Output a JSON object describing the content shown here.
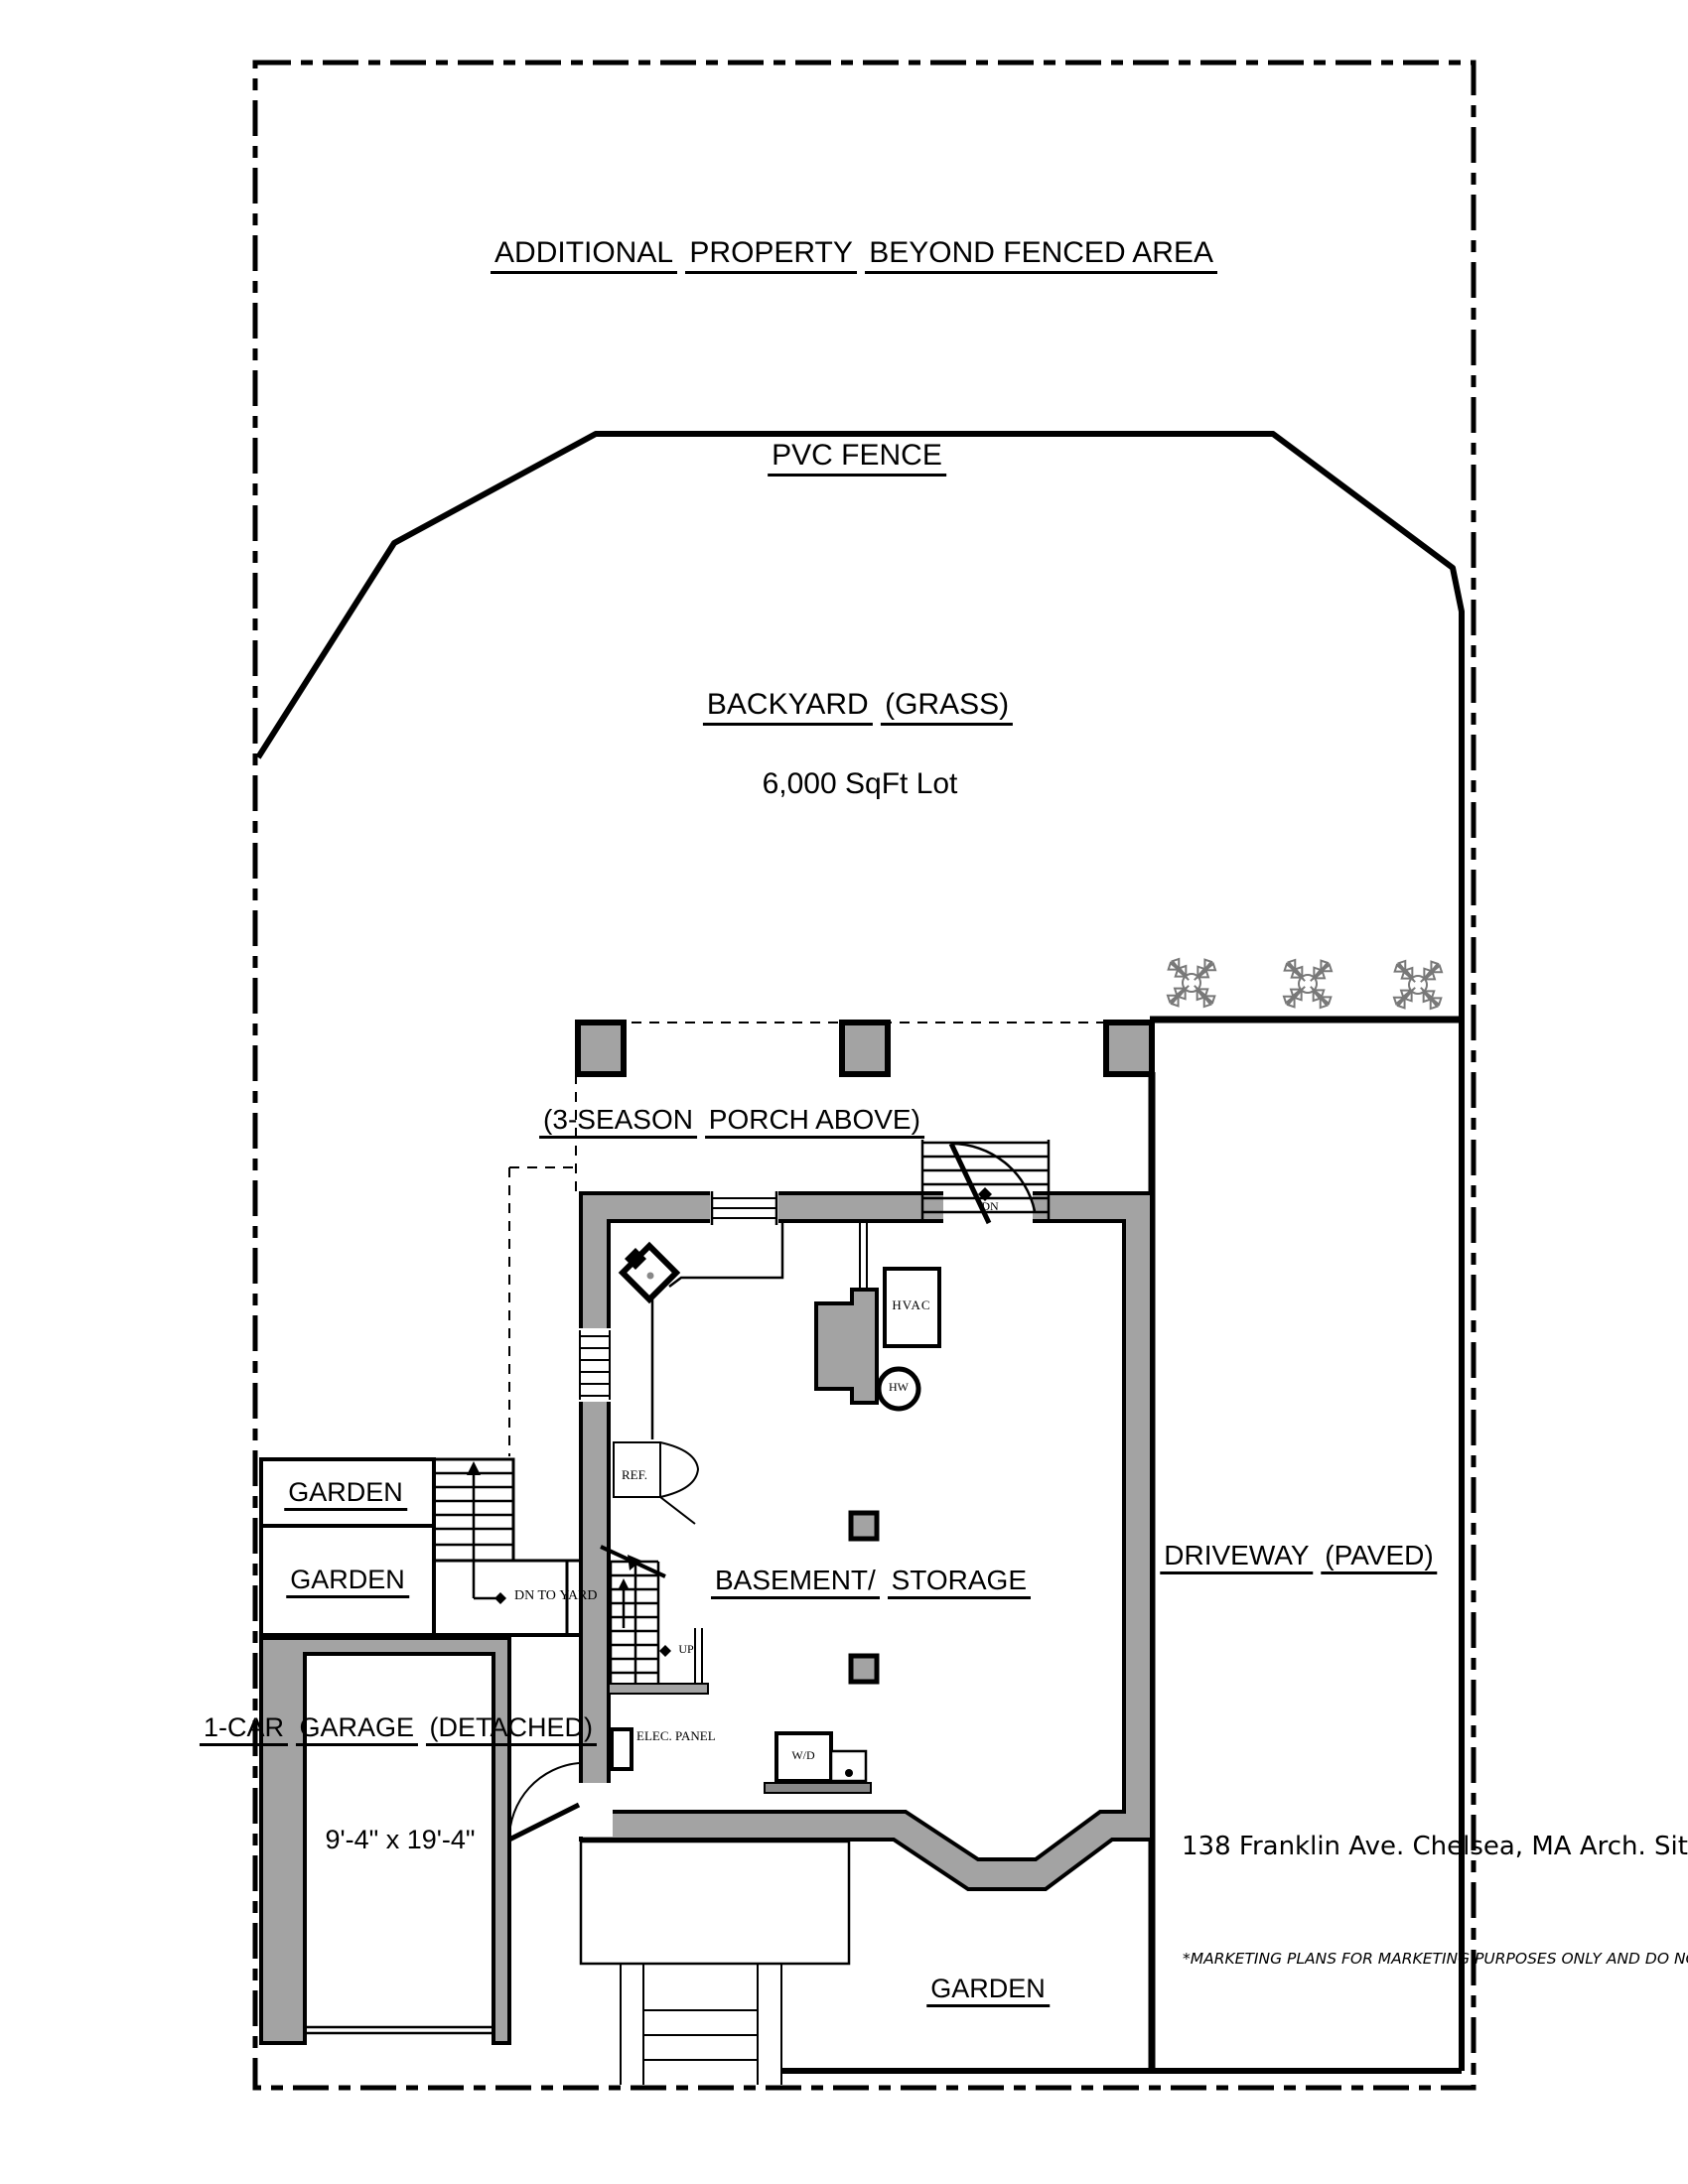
{
  "plan": {
    "colors": {
      "wall_fill": "#a3a3a3",
      "line": "#000000",
      "shrub": "#787878"
    },
    "areas": {
      "additional_property": {
        "line1": "ADDITIONAL",
        "line2": "PROPERTY",
        "line3": "BEYOND FENCED AREA"
      },
      "pvc_fence": {
        "label": "PVC FENCE"
      },
      "backyard": {
        "line1": "BACKYARD",
        "line2": "(GRASS)",
        "lot": "6,000 SqFt Lot"
      },
      "porch": {
        "line1": "(3-SEASON",
        "line2": "PORCH ABOVE)"
      },
      "basement": {
        "line1": "BASEMENT/",
        "line2": "STORAGE"
      },
      "driveway": {
        "line1": "DRIVEWAY",
        "line2": "(PAVED)"
      },
      "garden_upper": {
        "label": "GARDEN"
      },
      "garden_lower": {
        "label": "GARDEN"
      },
      "garden_front": {
        "label": "GARDEN"
      },
      "garage": {
        "line1": "1-CAR",
        "line2": "GARAGE",
        "line3": "(DETACHED)",
        "dimensions": "9'-4\" x 19'-4\""
      }
    },
    "fixtures": {
      "hvac": "HVAC",
      "water_heater": "HW",
      "refrigerator": "REF.",
      "washer_dryer": "W/D",
      "electrical_panel": "ELEC. PANEL",
      "stair_down": "DN",
      "stair_up": "UP",
      "stair_down_to_yard_line1": "DN TO",
      "stair_down_to_yard_line2": "YARD"
    },
    "title_block": {
      "address_line1": "138 Franklin Ave.",
      "address_line2": "Chelsea, MA",
      "address_line3": "Arch. Site Layout",
      "address_line4": "(For Reference Only)",
      "disclaimer": [
        "*MARKETING PLANS FOR",
        "MARKETING PURPOSES ONLY",
        "AND DO NOT REPRESENT",
        "CONSTRUCTION/",
        "CONDOMINIUM PLANS OR A",
        "CERTIFIED PLOT PLAN."
      ]
    }
  }
}
